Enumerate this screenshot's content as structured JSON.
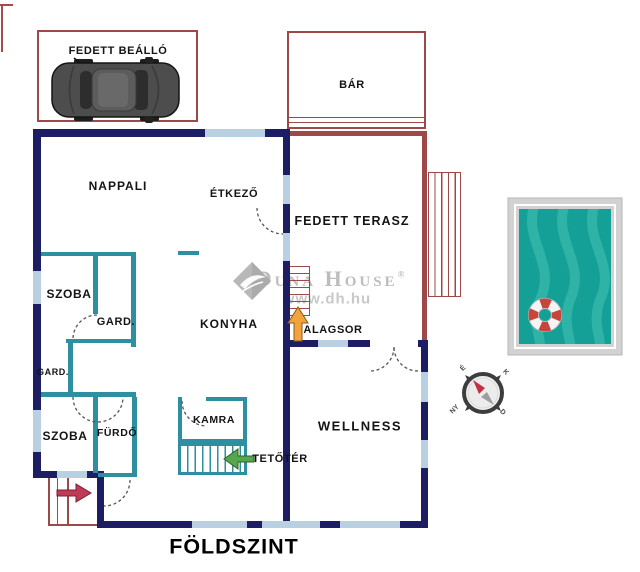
{
  "title": "FÖLDSZINT",
  "labels": {
    "carport": "FEDETT BEÁLLÓ",
    "bar": "BÁR",
    "living": "NAPPALI",
    "dining": "ÉTKEZŐ",
    "terrace": "FEDETT TERASZ",
    "room1": "SZOBA",
    "wardrobe1": "GARD.",
    "wardrobe2": "GARD.",
    "kitchen": "KONYHA",
    "basement": "ALAGSOR",
    "room2": "SZOBA",
    "bathroom": "FÜRDŐ",
    "pantry": "KAMRA",
    "attic": "TETŐTÉR",
    "wellness": "WELLNESS"
  },
  "watermark": {
    "brand": "Duna House",
    "registered": "®",
    "url": "www.dh.hu"
  },
  "compass": {
    "north": "É",
    "east": "K",
    "west": "NY",
    "south": "D"
  },
  "colors": {
    "wall_navy": "#1d1d63",
    "wall_teal": "#2d8fa0",
    "window_blue": "#b9cfe2",
    "outline_red": "#9e4848",
    "arrow_entry": "#bf3a55",
    "arrow_attic": "#55a74e",
    "arrow_basement": "#f2a33c",
    "pool_water": "#14a097",
    "pool_wave": "#2fb3a7",
    "lifebuoy_red": "#c8453c",
    "watermark_gray": "#bdbdbd",
    "label_black": "#141414"
  }
}
